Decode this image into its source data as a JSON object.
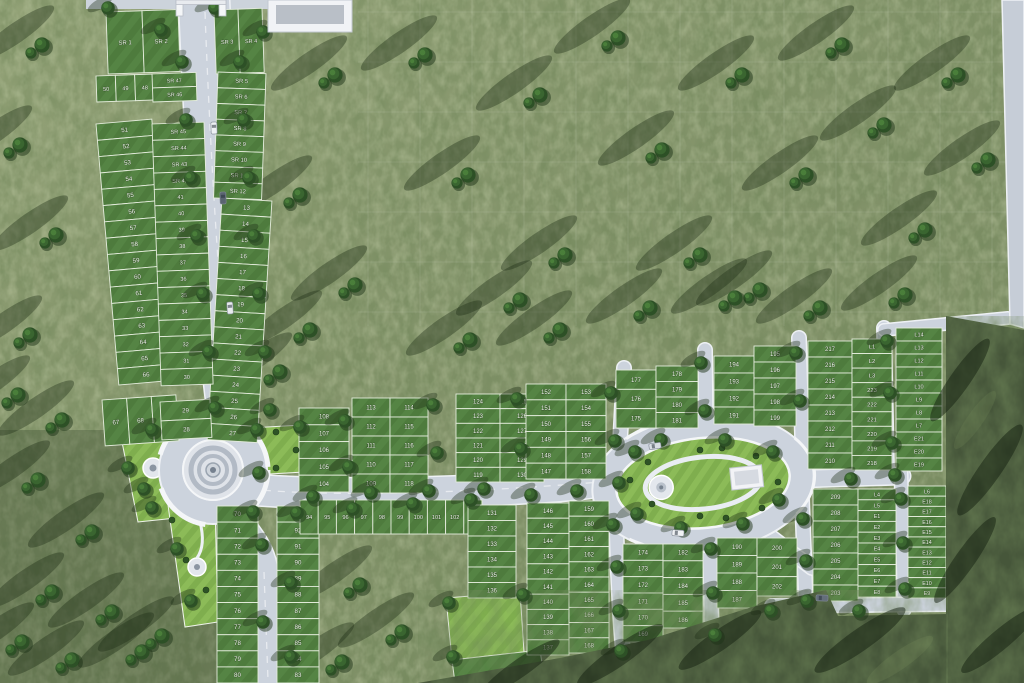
{
  "scene": "aerial-site-plan-render",
  "palette": {
    "grass_light": "#8f9e74",
    "grass_dark": "#76865c",
    "forest": "#46563a",
    "road": "#ccd3dd",
    "road_edge": "#eef1f5",
    "plot_green": "#4e7b3d",
    "plot_green_light": "#5c8c48",
    "park_green": "#8ab74f",
    "label_color": "#f3f7ee"
  },
  "landmarks": {
    "entrance_gate": "main entrance gate (top)",
    "gate_building": "entrance-side building",
    "roundabout": "circular traffic roundabout with concentric island",
    "oval_park": "central oval park with ring road, plaza circle and pavilion",
    "fountain_circle_west": "small circular plaza in west lawn",
    "fountain_circle_south": "small circular plaza in south lawn",
    "amenity_lawn": "bright green amenity lawn (bottom centre)"
  },
  "plot_groups": [
    {
      "id": "sr1-2",
      "dir": "h",
      "x": 106,
      "y": 12,
      "w": 72,
      "h": 62,
      "fs": 6,
      "rot": -2,
      "labels": [
        "SR 1",
        "SR 2"
      ]
    },
    {
      "id": "sr3-4",
      "dir": "h",
      "x": 214,
      "y": 10,
      "w": 48,
      "h": 64,
      "fs": 5.6,
      "rot": -2,
      "labels": [
        "SR 3",
        "SR 4"
      ]
    },
    {
      "id": "r50-48",
      "dir": "h",
      "x": 96,
      "y": 76,
      "w": 58,
      "h": 26,
      "fs": 5.6,
      "rot": -2,
      "labels": [
        "50",
        "49",
        "48"
      ]
    },
    {
      "id": "sr47-46",
      "dir": "v",
      "x": 152,
      "y": 74,
      "w": 44,
      "h": 28,
      "fs": 5.4,
      "rot": -2,
      "labels": [
        "SR 47",
        "SR 46"
      ]
    },
    {
      "id": "sr5-12",
      "dir": "v",
      "x": 218,
      "y": 72,
      "w": 48,
      "h": 126,
      "fs": 5.8,
      "rot": 2,
      "labels": [
        "SR 5",
        "SR 6",
        "SR 7",
        "SR 8",
        "SR 9",
        "SR 10",
        "SR 11",
        "SR 12"
      ]
    },
    {
      "id": "p13-27",
      "dir": "v",
      "x": 222,
      "y": 198,
      "w": 50,
      "h": 242,
      "fs": 6.2,
      "rot": 3.5,
      "labels": [
        "13",
        "14",
        "15",
        "16",
        "17",
        "18",
        "19",
        "20",
        "21",
        "22",
        "23",
        "24",
        "25",
        "26",
        "27"
      ]
    },
    {
      "id": "p51-66",
      "dir": "v",
      "x": 96,
      "y": 124,
      "w": 56,
      "h": 262,
      "fs": 6.2,
      "rot": -5,
      "labels": [
        "51",
        "52",
        "53",
        "54",
        "55",
        "56",
        "57",
        "58",
        "59",
        "60",
        "61",
        "62",
        "63",
        "64",
        "65",
        "66"
      ]
    },
    {
      "id": "sr45-30",
      "dir": "v",
      "x": 152,
      "y": 124,
      "w": 52,
      "h": 262,
      "fs": 5.6,
      "rot": -2,
      "labels": [
        "SR 45",
        "SR 44",
        "SR 43",
        "SR 42",
        "41",
        "40",
        "39",
        "38",
        "37",
        "36",
        "35",
        "34",
        "33",
        "32",
        "31",
        "30"
      ]
    },
    {
      "id": "p67-69",
      "dir": "h",
      "x": 102,
      "y": 400,
      "w": 74,
      "h": 46,
      "fs": 6.2,
      "rot": -4,
      "labels": [
        "67",
        "68",
        "69"
      ]
    },
    {
      "id": "p29-28",
      "dir": "v",
      "x": 160,
      "y": 402,
      "w": 50,
      "h": 38,
      "fs": 6.2,
      "rot": -3,
      "labels": [
        "29",
        "28"
      ]
    },
    {
      "id": "p70-80",
      "dir": "v",
      "x": 217,
      "y": 506,
      "w": 41,
      "h": 177,
      "fs": 6.2,
      "labels": [
        "70",
        "71",
        "72",
        "73",
        "74",
        "75",
        "76",
        "77",
        "78",
        "79",
        "80"
      ]
    },
    {
      "id": "p93-83",
      "dir": "v",
      "x": 277,
      "y": 506,
      "w": 42,
      "h": 177,
      "fs": 6.2,
      "labels": [
        "93",
        "92",
        "91",
        "90",
        "89",
        "88",
        "87",
        "86",
        "85",
        "84",
        "83"
      ]
    },
    {
      "id": "p94-103",
      "dir": "h",
      "x": 300,
      "y": 500,
      "w": 182,
      "h": 34,
      "fs": 5.6,
      "labels": [
        "94",
        "95",
        "96",
        "97",
        "98",
        "99",
        "100",
        "101",
        "102",
        "103"
      ]
    },
    {
      "id": "p108-104",
      "dir": "v",
      "x": 299,
      "y": 408,
      "w": 50,
      "h": 84,
      "fs": 6,
      "labels": [
        "108",
        "107",
        "106",
        "105",
        "104"
      ]
    },
    {
      "id": "p113-109",
      "dir": "v",
      "x": 352,
      "y": 398,
      "w": 38,
      "h": 95,
      "fs": 6,
      "labels": [
        "113",
        "112",
        "111",
        "110",
        "109"
      ]
    },
    {
      "id": "p114-118",
      "dir": "v",
      "x": 390,
      "y": 398,
      "w": 38,
      "h": 95,
      "fs": 6,
      "labels": [
        "114",
        "115",
        "116",
        "117",
        "118"
      ]
    },
    {
      "id": "p124-119",
      "dir": "v",
      "x": 456,
      "y": 394,
      "w": 44,
      "h": 88,
      "fs": 6,
      "labels": [
        "124",
        "123",
        "122",
        "121",
        "120",
        "119"
      ]
    },
    {
      "id": "p125-130",
      "dir": "v",
      "x": 500,
      "y": 394,
      "w": 44,
      "h": 88,
      "fs": 6,
      "labels": [
        "125",
        "126",
        "127",
        "128",
        "129",
        "130"
      ]
    },
    {
      "id": "p152-147",
      "dir": "v",
      "x": 526,
      "y": 384,
      "w": 40,
      "h": 95,
      "fs": 6,
      "labels": [
        "152",
        "151",
        "150",
        "149",
        "148",
        "147"
      ]
    },
    {
      "id": "p153-158",
      "dir": "v",
      "x": 566,
      "y": 384,
      "w": 40,
      "h": 95,
      "fs": 6,
      "labels": [
        "153",
        "154",
        "155",
        "156",
        "157",
        "158"
      ]
    },
    {
      "id": "p177-175",
      "dir": "v",
      "x": 616,
      "y": 370,
      "w": 40,
      "h": 58,
      "fs": 6,
      "labels": [
        "177",
        "176",
        "175"
      ]
    },
    {
      "id": "p178-181",
      "dir": "v",
      "x": 656,
      "y": 366,
      "w": 42,
      "h": 62,
      "fs": 6,
      "labels": [
        "178",
        "179",
        "180",
        "181"
      ]
    },
    {
      "id": "p194-191",
      "dir": "v",
      "x": 714,
      "y": 356,
      "w": 40,
      "h": 68,
      "fs": 6,
      "labels": [
        "194",
        "193",
        "192",
        "191"
      ]
    },
    {
      "id": "p195-199",
      "dir": "v",
      "x": 754,
      "y": 346,
      "w": 42,
      "h": 80,
      "fs": 6,
      "labels": [
        "195",
        "196",
        "197",
        "198",
        "199"
      ]
    },
    {
      "id": "p217-210",
      "dir": "v",
      "x": 808,
      "y": 341,
      "w": 44,
      "h": 128,
      "fs": 6,
      "labels": [
        "217",
        "216",
        "215",
        "214",
        "213",
        "212",
        "211",
        "210"
      ]
    },
    {
      "id": "L1-218",
      "dir": "v",
      "x": 852,
      "y": 339,
      "w": 40,
      "h": 131,
      "fs": 5.8,
      "labels": [
        "L1",
        "L2",
        "L3",
        "223",
        "222",
        "221",
        "220",
        "219",
        "218"
      ]
    },
    {
      "id": "L14-E19",
      "dir": "v",
      "x": 896,
      "y": 328,
      "w": 46,
      "h": 143,
      "fs": 5.6,
      "labels": [
        "L14",
        "L13",
        "L12",
        "L11",
        "L10",
        "L9",
        "L8",
        "L7",
        "E21",
        "E20",
        "E19"
      ]
    },
    {
      "id": "p131-136",
      "dir": "v",
      "x": 468,
      "y": 505,
      "w": 48,
      "h": 93,
      "fs": 6,
      "labels": [
        "131",
        "132",
        "133",
        "134",
        "135",
        "136"
      ]
    },
    {
      "id": "p146-137",
      "dir": "v",
      "x": 527,
      "y": 503,
      "w": 42,
      "h": 152,
      "fs": 6,
      "labels": [
        "146",
        "145",
        "144",
        "143",
        "142",
        "141",
        "140",
        "139",
        "138",
        "137"
      ]
    },
    {
      "id": "p159-168",
      "dir": "v",
      "x": 569,
      "y": 501,
      "w": 40,
      "h": 152,
      "fs": 6,
      "labels": [
        "159",
        "160",
        "161",
        "162",
        "163",
        "164",
        "165",
        "166",
        "167",
        "168"
      ]
    },
    {
      "id": "p174-169",
      "dir": "v",
      "x": 623,
      "y": 544,
      "w": 40,
      "h": 98,
      "fs": 6,
      "labels": [
        "174",
        "173",
        "172",
        "171",
        "170",
        "169"
      ]
    },
    {
      "id": "p182-186",
      "dir": "v",
      "x": 663,
      "y": 544,
      "w": 40,
      "h": 84,
      "fs": 6,
      "labels": [
        "182",
        "183",
        "184",
        "185",
        "186"
      ]
    },
    {
      "id": "p190-187",
      "dir": "v",
      "x": 717,
      "y": 538,
      "w": 40,
      "h": 70,
      "fs": 6,
      "labels": [
        "190",
        "189",
        "188",
        "187"
      ]
    },
    {
      "id": "p200-202",
      "dir": "v",
      "x": 757,
      "y": 538,
      "w": 40,
      "h": 58,
      "fs": 6,
      "labels": [
        "200",
        "201",
        "202"
      ]
    },
    {
      "id": "p209-203",
      "dir": "v",
      "x": 813,
      "y": 489,
      "w": 45,
      "h": 112,
      "fs": 6,
      "labels": [
        "209",
        "208",
        "207",
        "206",
        "205",
        "204",
        "203"
      ]
    },
    {
      "id": "L4-E8",
      "dir": "v",
      "x": 858,
      "y": 489,
      "w": 38,
      "h": 108,
      "fs": 5.4,
      "labels": [
        "L4",
        "L5",
        "E1",
        "E2",
        "E3",
        "E4",
        "E5",
        "E6",
        "E7",
        "E8"
      ]
    },
    {
      "id": "L6-E9",
      "dir": "v",
      "x": 908,
      "y": 486,
      "w": 38,
      "h": 112,
      "fs": 5.4,
      "labels": [
        "L6",
        "E18",
        "E17",
        "E16",
        "E15",
        "E14",
        "E13",
        "E12",
        "E11",
        "E10",
        "E9"
      ]
    }
  ],
  "decor": {
    "trees": [
      [
        182,
        62
      ],
      [
        240,
        62
      ],
      [
        186,
        120
      ],
      [
        244,
        120
      ],
      [
        191,
        178
      ],
      [
        249,
        178
      ],
      [
        197,
        236
      ],
      [
        254,
        236
      ],
      [
        203,
        294
      ],
      [
        259,
        294
      ],
      [
        209,
        352
      ],
      [
        265,
        352
      ],
      [
        215,
        408
      ],
      [
        270,
        410
      ],
      [
        108,
        8
      ],
      [
        161,
        30
      ],
      [
        215,
        8
      ],
      [
        263,
        32
      ],
      [
        152,
        430
      ],
      [
        128,
        468
      ],
      [
        152,
        508
      ],
      [
        257,
        430
      ],
      [
        300,
        427
      ],
      [
        259,
        473
      ],
      [
        262,
        545
      ],
      [
        291,
        583
      ],
      [
        263,
        622
      ],
      [
        291,
        657
      ],
      [
        253,
        512
      ],
      [
        297,
        513
      ],
      [
        313,
        497
      ],
      [
        371,
        493
      ],
      [
        429,
        491
      ],
      [
        484,
        489
      ],
      [
        345,
        421
      ],
      [
        349,
        467
      ],
      [
        433,
        405
      ],
      [
        437,
        453
      ],
      [
        517,
        399
      ],
      [
        521,
        449
      ],
      [
        611,
        393
      ],
      [
        615,
        441
      ],
      [
        701,
        363
      ],
      [
        705,
        411
      ],
      [
        796,
        353
      ],
      [
        800,
        401
      ],
      [
        887,
        341
      ],
      [
        890,
        393
      ],
      [
        892,
        443
      ],
      [
        353,
        509
      ],
      [
        413,
        504
      ],
      [
        471,
        500
      ],
      [
        531,
        495
      ],
      [
        577,
        491
      ],
      [
        635,
        452
      ],
      [
        619,
        483
      ],
      [
        637,
        514
      ],
      [
        681,
        528
      ],
      [
        743,
        524
      ],
      [
        779,
        500
      ],
      [
        773,
        452
      ],
      [
        725,
        440
      ],
      [
        661,
        440
      ],
      [
        613,
        525
      ],
      [
        617,
        567
      ],
      [
        619,
        611
      ],
      [
        621,
        651
      ],
      [
        711,
        549
      ],
      [
        713,
        593
      ],
      [
        715,
        635
      ],
      [
        803,
        519
      ],
      [
        806,
        561
      ],
      [
        807,
        601
      ],
      [
        901,
        499
      ],
      [
        903,
        543
      ],
      [
        905,
        589
      ],
      [
        859,
        611
      ],
      [
        771,
        611
      ],
      [
        851,
        479
      ],
      [
        895,
        475
      ],
      [
        144,
        489
      ],
      [
        191,
        601
      ],
      [
        177,
        549
      ],
      [
        449,
        603
      ],
      [
        523,
        595
      ],
      [
        453,
        657
      ]
    ],
    "clusters": [
      [
        335,
        75
      ],
      [
        300,
        195
      ],
      [
        355,
        285
      ],
      [
        425,
        55
      ],
      [
        468,
        175
      ],
      [
        540,
        95
      ],
      [
        565,
        255
      ],
      [
        618,
        38
      ],
      [
        662,
        150
      ],
      [
        700,
        255
      ],
      [
        742,
        75
      ],
      [
        806,
        175
      ],
      [
        842,
        45
      ],
      [
        884,
        125
      ],
      [
        925,
        230
      ],
      [
        958,
        75
      ],
      [
        988,
        160
      ],
      [
        520,
        300
      ],
      [
        760,
        290
      ],
      [
        905,
        295
      ],
      [
        42,
        45
      ],
      [
        20,
        145
      ],
      [
        56,
        235
      ],
      [
        30,
        335
      ],
      [
        62,
        420
      ],
      [
        18,
        395
      ],
      [
        38,
        480
      ],
      [
        92,
        532
      ],
      [
        52,
        592
      ],
      [
        112,
        612
      ],
      [
        72,
        660
      ],
      [
        142,
        652
      ],
      [
        22,
        642
      ],
      [
        162,
        636
      ],
      [
        360,
        585
      ],
      [
        402,
        632
      ],
      [
        342,
        662
      ],
      [
        300,
        612
      ],
      [
        310,
        330
      ],
      [
        280,
        372
      ],
      [
        470,
        340
      ],
      [
        560,
        330
      ],
      [
        650,
        308
      ],
      [
        735,
        298
      ],
      [
        820,
        308
      ]
    ],
    "cars": [
      [
        214,
        128,
        88,
        "#eef1f4"
      ],
      [
        223,
        198,
        88,
        "#5a6470"
      ],
      [
        230,
        308,
        86,
        "#e8ebef"
      ],
      [
        655,
        446,
        -8,
        "#d8dde3"
      ],
      [
        678,
        533,
        4,
        "#f0f2f5"
      ],
      [
        822,
        598,
        2,
        "#646e7a"
      ]
    ],
    "bushes": [
      [
        630,
        480
      ],
      [
        648,
        462
      ],
      [
        652,
        504
      ],
      [
        700,
        450
      ],
      [
        700,
        516
      ],
      [
        756,
        456
      ],
      [
        762,
        508
      ],
      [
        778,
        482
      ],
      [
        722,
        448
      ],
      [
        726,
        518
      ],
      [
        276,
        432
      ],
      [
        276,
        468
      ],
      [
        296,
        450
      ],
      [
        172,
        520
      ],
      [
        206,
        590
      ],
      [
        186,
        560
      ]
    ],
    "grid": {
      "x0": 368,
      "x1": 1000,
      "xstep": 52,
      "y0": 0,
      "y1": 326,
      "ystep": 50
    }
  }
}
